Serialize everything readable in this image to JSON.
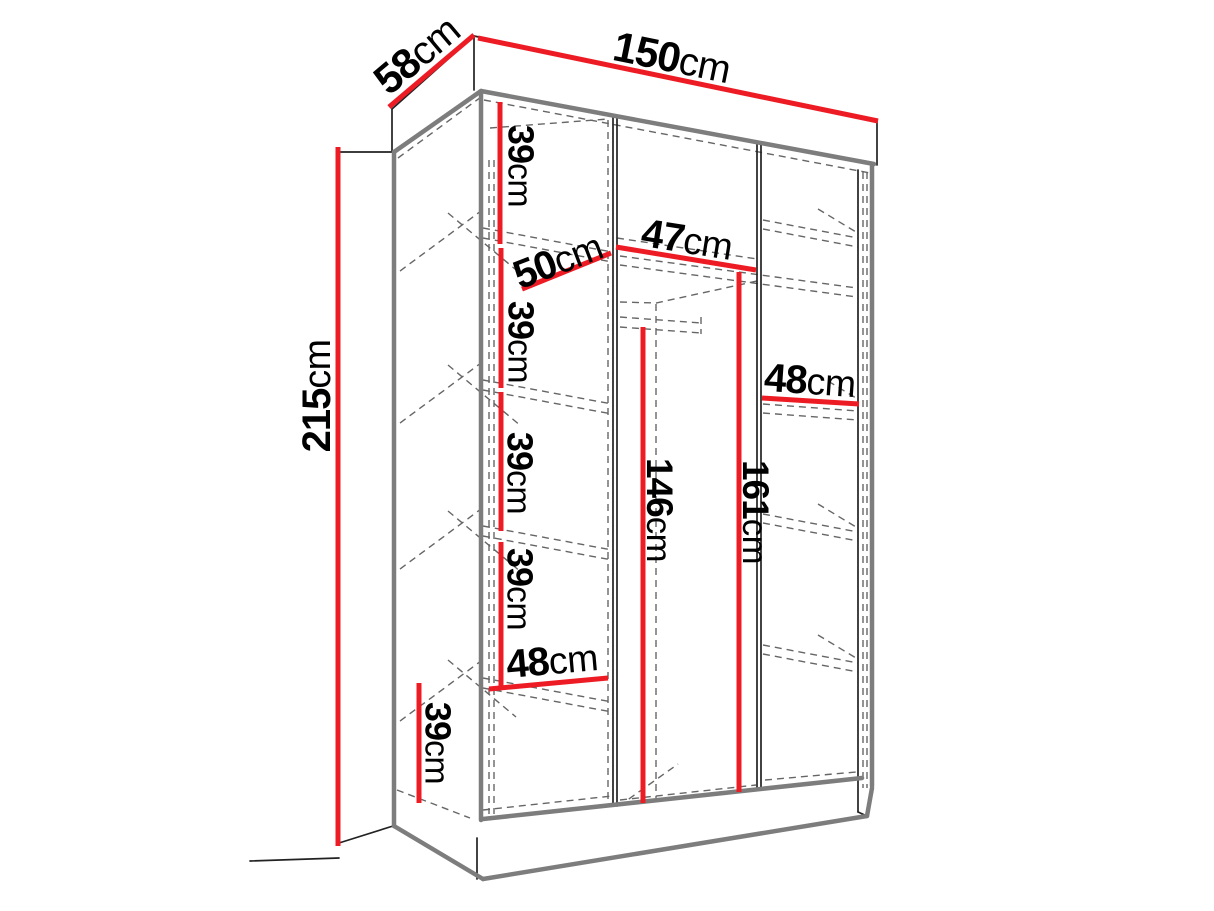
{
  "figure": {
    "kind": "furniture dimension line drawing",
    "unit": "cm"
  },
  "colors": {
    "dimension_line": "#ed1c24",
    "outline_strong": "#7d7d7d",
    "outline_thin": "#222222",
    "hidden_line": "#666666",
    "label_text": "#000000",
    "background": "#ffffff"
  },
  "dimensions": {
    "depth_top": {
      "value": "58",
      "unit": "cm"
    },
    "width_top": {
      "value": "150",
      "unit": "cm"
    },
    "height_left": {
      "value": "215",
      "unit": "cm"
    },
    "shelf_gap_1": {
      "value": "39",
      "unit": "cm"
    },
    "shelf_gap_2": {
      "value": "39",
      "unit": "cm"
    },
    "shelf_gap_3": {
      "value": "39",
      "unit": "cm"
    },
    "shelf_gap_4": {
      "value": "39",
      "unit": "cm"
    },
    "shelf_depth": {
      "value": "50",
      "unit": "cm"
    },
    "middle_width": {
      "value": "47",
      "unit": "cm"
    },
    "right_shelf_width": {
      "value": "48",
      "unit": "cm"
    },
    "hang_height_mid": {
      "value": "146",
      "unit": "cm"
    },
    "hang_height_right": {
      "value": "161",
      "unit": "cm"
    },
    "bottom_width": {
      "value": "48",
      "unit": "cm"
    },
    "bottom_height": {
      "value": "39",
      "unit": "cm"
    }
  }
}
